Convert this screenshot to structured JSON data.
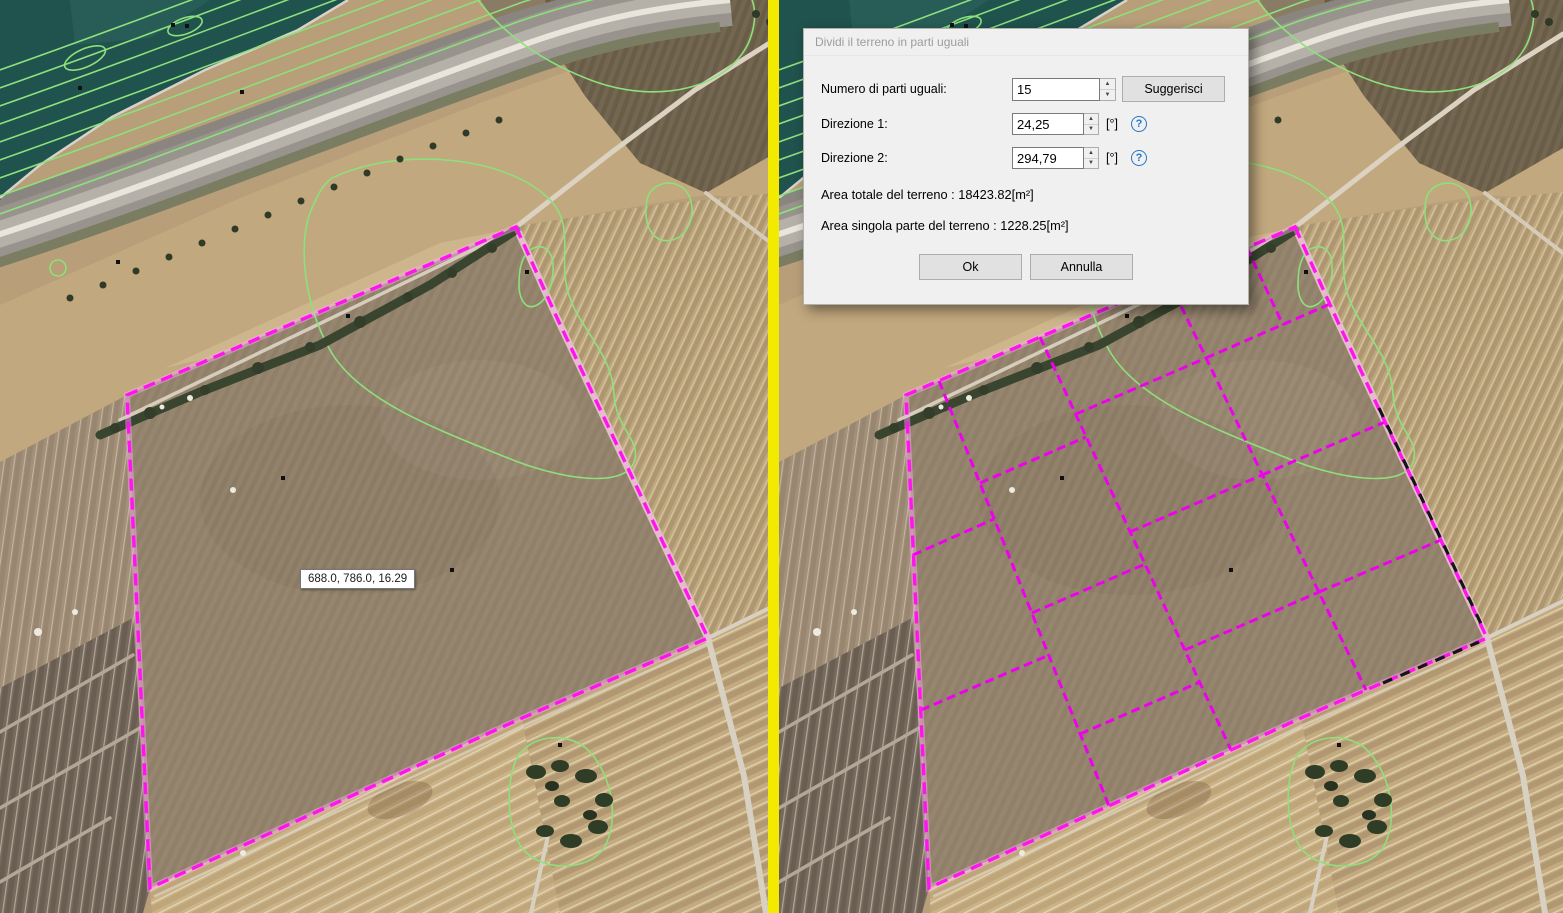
{
  "app_title": "Divisione terreno - confronto prima/dopo",
  "divider": {
    "color": "#f2ea00"
  },
  "tooltip": {
    "text": "688.0, 786.0, 16.29"
  },
  "icons": {
    "spinner_up": "▲",
    "spinner_down": "▼",
    "help": "?"
  },
  "dialog": {
    "title": "Dividi il terreno in parti uguali",
    "rows": [
      {
        "label": "Numero di parti uguali:",
        "value": "15",
        "button": "Suggerisci"
      },
      {
        "label": "Direzione 1:",
        "value": "24,25",
        "unit": "[°]"
      },
      {
        "label": "Direzione 2:",
        "value": "294,79",
        "unit": "[°]"
      }
    ],
    "info": [
      "Area totale del terreno : 18423.82[m²]",
      "Area singola parte del terreno : 1228.25[m²]"
    ],
    "buttons": {
      "ok": "Ok",
      "cancel": "Annulla"
    }
  },
  "map": {
    "colors": {
      "parcel_outline": "#ff14f0",
      "parcel_glow": "#ffaef2",
      "division": "#ee00ee",
      "black_dash": "#151515",
      "contour": "#8de07b",
      "water": "#20524e"
    },
    "parcel_polygon": [
      [
        516,
        227
      ],
      [
        558,
        320
      ],
      [
        708,
        638
      ],
      [
        522,
        718
      ],
      [
        150,
        888
      ],
      [
        127,
        395
      ]
    ],
    "division_lines": [
      [
        160,
        381,
        330,
        806
      ],
      [
        261,
        337,
        452,
        750
      ],
      [
        390,
        281,
        587,
        690
      ],
      [
        468,
        248,
        504,
        325
      ],
      [
        134,
        555,
        215,
        519
      ],
      [
        142,
        710,
        270,
        655
      ],
      [
        201,
        483,
        307,
        437
      ],
      [
        253,
        613,
        366,
        564
      ],
      [
        301,
        734,
        421,
        682
      ],
      [
        297,
        414,
        427,
        358
      ],
      [
        351,
        532,
        483,
        475
      ],
      [
        406,
        650,
        540,
        592
      ],
      [
        427,
        358,
        551,
        304
      ],
      [
        483,
        475,
        606,
        422
      ],
      [
        540,
        592,
        662,
        540
      ]
    ],
    "black_edge_segments": [
      [
        600,
        408,
        704,
        628
      ],
      [
        604,
        683,
        700,
        642
      ]
    ],
    "contour_parallels": {
      "count": 9,
      "base_y": 72,
      "dy": 18
    },
    "markers": [
      [
        173,
        25
      ],
      [
        187,
        26
      ],
      [
        80,
        88
      ],
      [
        242,
        92
      ],
      [
        118,
        262
      ],
      [
        348,
        316
      ],
      [
        452,
        570
      ],
      [
        283,
        478
      ],
      [
        527,
        272
      ],
      [
        560,
        745
      ]
    ]
  }
}
